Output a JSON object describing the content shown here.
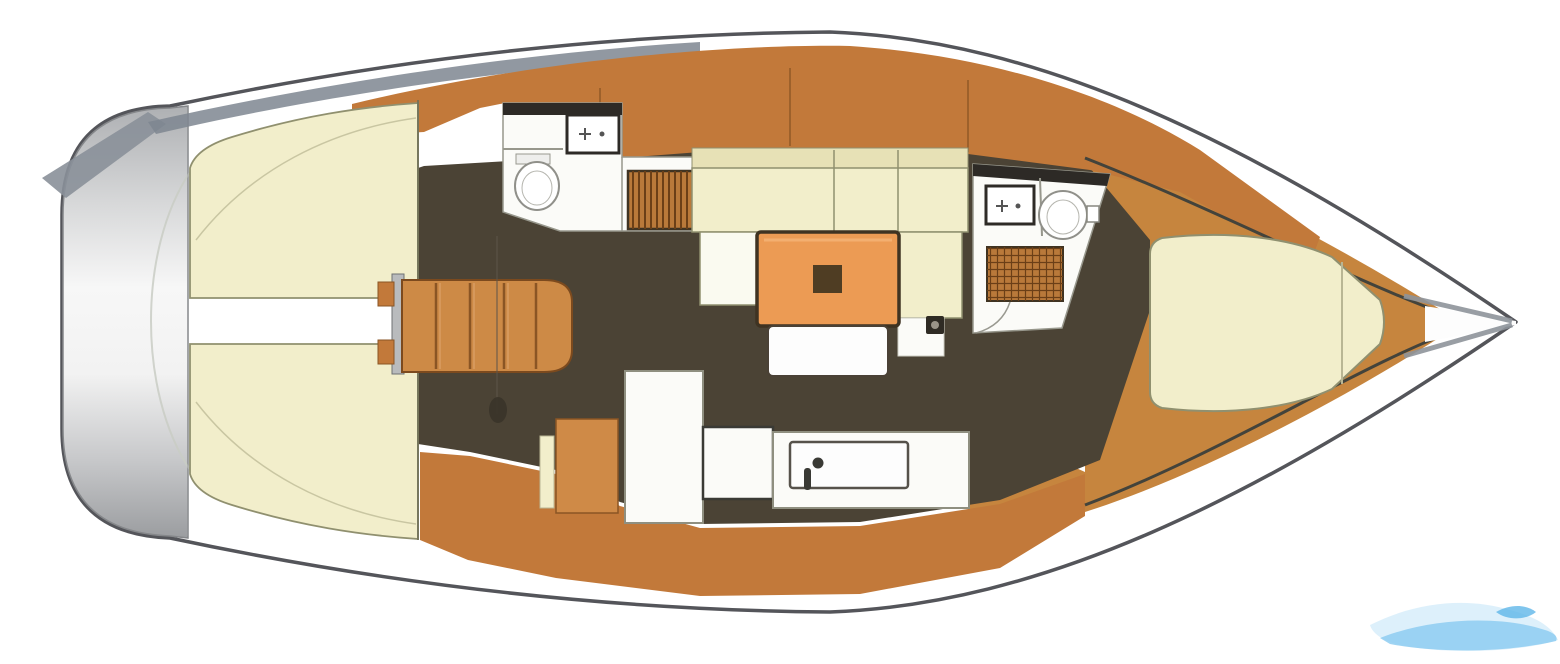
{
  "palette": {
    "background": "#ffffff",
    "hull_outline": "#54555a",
    "hull_fill": "#ffffff",
    "shadow_gray": "#7e8690",
    "shadow_tail": "#8a9099",
    "transom_gray_top": "#aeb0b3",
    "transom_gray_bottom": "#9b9da0",
    "teak": "#c2793a",
    "teak_light": "#cf8a47",
    "teak_line": "#8a5524",
    "bow_wood": "#c6853e",
    "floor_dark": "#4b4335",
    "cushion_cream": "#f2eecb",
    "cushion_cream_dark": "#e7e1b6",
    "cushion_outline": "#90906f",
    "room_white": "#fbfbf8",
    "room_outline": "#97978c",
    "fixture_dark": "#2d2a26",
    "fixture_stroke": "#90908a",
    "table_orange": "#ec9b54",
    "table_border": "#3f3322",
    "table_inset": "#4f3d23",
    "bench_white": "#fdfdfd",
    "stairs_orange": "#cd8a46",
    "stairs_frame_gray": "#b9bbbd",
    "grate_wood": "#b9793a",
    "grate_line": "#6b3f17",
    "bed_seam": "#c9c6a2",
    "watermark_light": "#d9eefb",
    "watermark_mid": "#8ecdf1",
    "watermark_deep": "#5fb7e8"
  },
  "watermark": {
    "present": true,
    "position": "bottom-right"
  },
  "components": [
    "hull-outline",
    "transom-swim-platform",
    "hull-shadow-band",
    "hull-shadow-tail",
    "aft-cabin-port-berth",
    "aft-cabin-starboard-berth",
    "aft-cabin-walkway-seam",
    "companionway-frame",
    "companionway-stairs",
    "companionway-ladder-rail",
    "keel-post",
    "aft-head-room",
    "aft-head-top-locker",
    "aft-head-sink",
    "aft-head-toilet",
    "aft-head-shower-grate",
    "side-deck-teak-top",
    "side-deck-teak-bottom",
    "cabin-floor",
    "salon-settee-backrest",
    "salon-settee-seat",
    "salon-settee-left-return",
    "salon-settee-right-return",
    "salon-table",
    "salon-table-inset",
    "salon-bench",
    "mast-post",
    "galley-cabinet",
    "galley-fridge",
    "galley-counter-small",
    "galley-counter",
    "galley-sink",
    "galley-faucet",
    "fwd-head-room",
    "fwd-head-top-locker",
    "fwd-head-sink",
    "fwd-head-toilet",
    "fwd-head-shower-grate",
    "bow-wood-deck",
    "bow-inner-line-top",
    "bow-inner-line-bottom",
    "bow-tip-shading",
    "vberth-bed",
    "vberth-divider",
    "watermark-wave"
  ]
}
